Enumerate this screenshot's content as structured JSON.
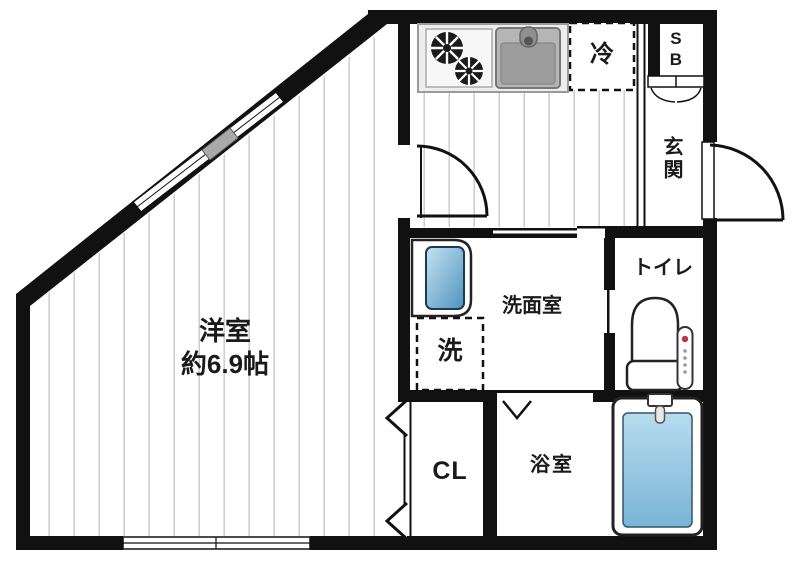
{
  "floor_plan": {
    "rooms": {
      "western_room": {
        "name": "洋室",
        "size": "約6.9帖"
      },
      "washroom": {
        "name": "洗面室"
      },
      "toilet": {
        "name": "トイレ"
      },
      "entrance": {
        "name": "玄関"
      },
      "bathroom": {
        "name": "浴室"
      },
      "closet": {
        "name": "CL"
      },
      "shoe_box": {
        "name": "SB"
      },
      "refrigerator_space": {
        "name": "冷"
      },
      "washer_space": {
        "name": "洗"
      }
    },
    "colors": {
      "wall": "#111111",
      "floor_line": "#cccccc",
      "tub_light": "#b7dcef",
      "tub_dark": "#79b4d6",
      "basin_light": "#c6e3f2",
      "basin_dark": "#4e93bd",
      "sink_gray": "#b5b5b5",
      "stove_black": "#1b1b1b",
      "accent_red": "#b93848"
    }
  }
}
